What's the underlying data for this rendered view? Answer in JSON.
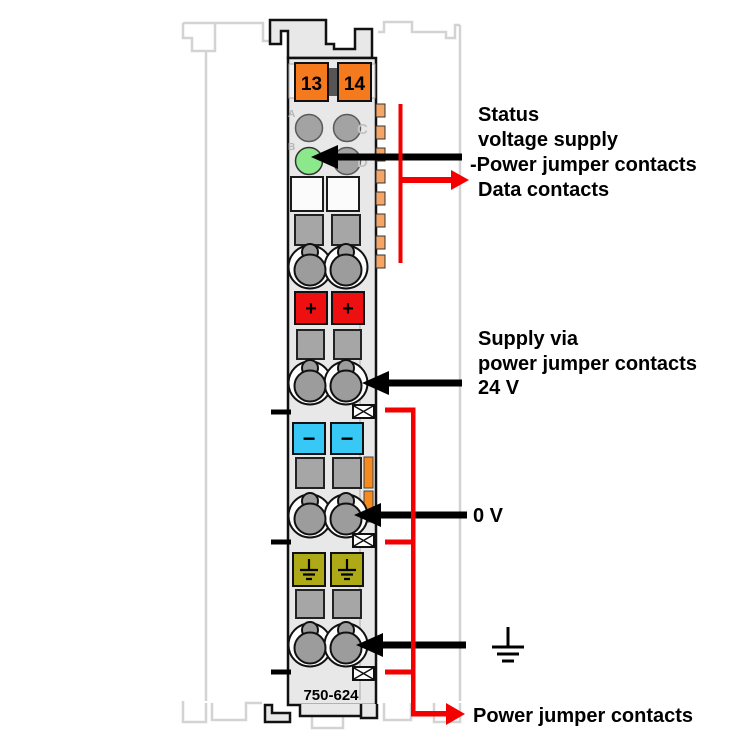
{
  "device": {
    "part_number": "750-624",
    "terminal_left": "13",
    "terminal_right": "14",
    "led_a": "A",
    "led_b": "B",
    "led_c": "C",
    "led_d": "D",
    "plus": "+",
    "minus": "−"
  },
  "callouts": {
    "status_line1": "Status",
    "status_line2": "voltage supply",
    "status_line3": "-Power jumper contacts",
    "data_contacts": "Data contacts",
    "supply_line1": "Supply via",
    "supply_line2": "power jumper contacts",
    "supply_line3": "24 V",
    "zero_volt": "0 V",
    "power_jumper": "Power jumper contacts"
  },
  "colors": {
    "callout_red": "#f50000",
    "terminal_orange": "#f5791d",
    "data_contact_orange": "#f5a566",
    "latch_orange": "#f68a1e",
    "led_green": "#8be98b",
    "minus_cyan": "#38c8f5",
    "plus_red": "#ee1010",
    "earth_olive": "#aea917",
    "body_gray": "#e8e8e8"
  }
}
